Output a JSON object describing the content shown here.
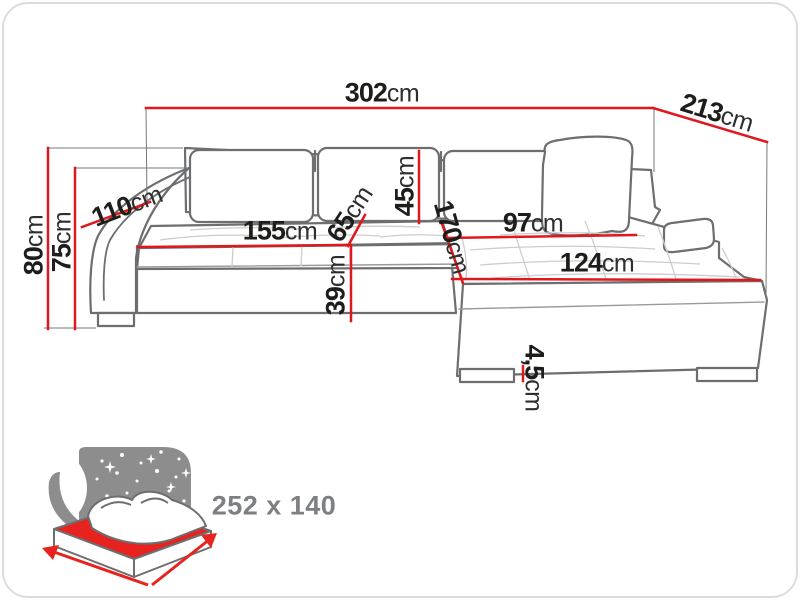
{
  "dimensions": {
    "total_width": {
      "num": "302",
      "unit": "cm"
    },
    "side_depth": {
      "num": "213",
      "unit": "cm"
    },
    "arm_section_depth": {
      "num": "110",
      "unit": "cm"
    },
    "total_height": {
      "num": "80",
      "unit": "cm"
    },
    "frame_height": {
      "num": "75",
      "unit": "cm"
    },
    "backrest_cushion_height": {
      "num": "45",
      "unit": "cm"
    },
    "seat_depth": {
      "num": "65",
      "unit": "cm"
    },
    "seat_width": {
      "num": "155",
      "unit": "cm"
    },
    "chaise_length": {
      "num": "170",
      "unit": "cm"
    },
    "seat_height": {
      "num": "39",
      "unit": "cm"
    },
    "chaise_seat_width": {
      "num": "97",
      "unit": "cm"
    },
    "chaise_total_width": {
      "num": "124",
      "unit": "cm"
    },
    "leg_height": {
      "num": "4,5",
      "unit": "cm"
    }
  },
  "bed_icon": {
    "icon_name": "sleeping-function-bed-icon",
    "sleeping_area": "252 x 140"
  },
  "colors": {
    "dimension_line": "#e0181d",
    "sofa_outline": "#6d6e70",
    "extension_line": "#77787a",
    "tuft_line": "#cdcdcd",
    "label_text": "#1d1d1b",
    "icon_gray": "#8d8d8d",
    "icon_red": "#e8231f",
    "size_text": "#7d7f82"
  }
}
